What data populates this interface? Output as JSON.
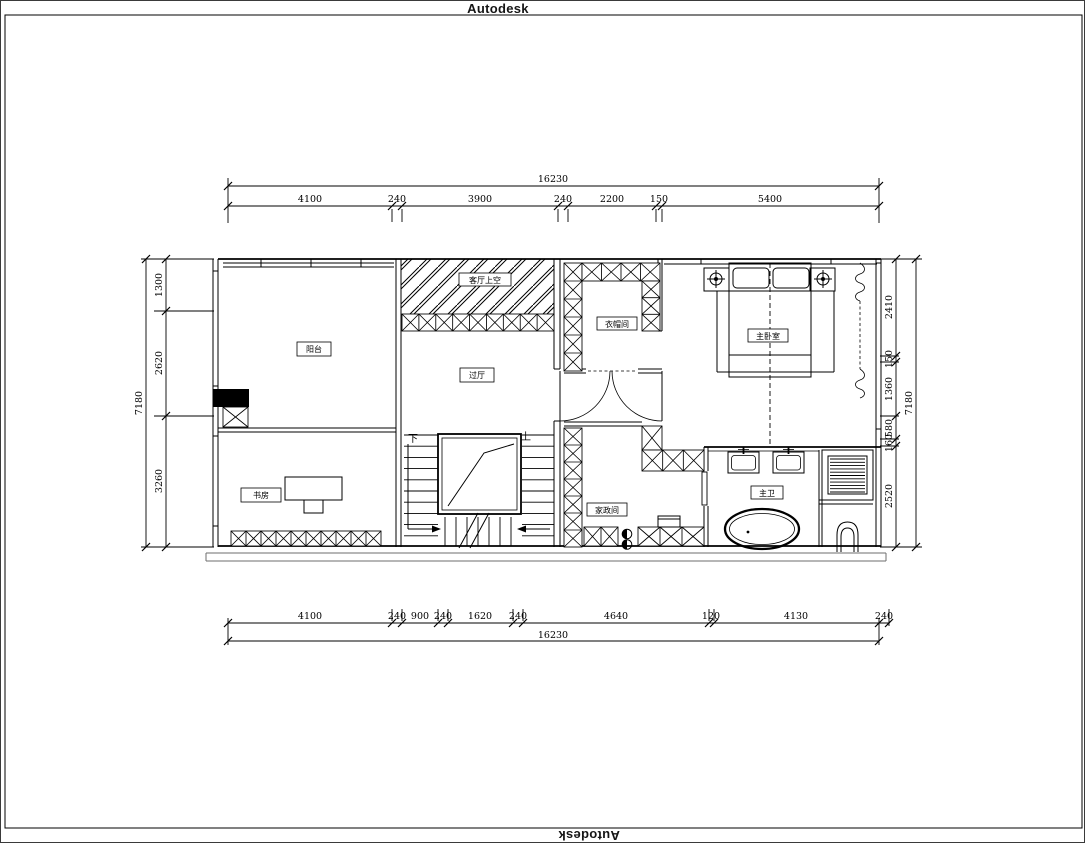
{
  "watermark": {
    "top_label": "Autodesk",
    "bottom_label": "Autodesk"
  },
  "rooms": {
    "balcony": "阳台",
    "study": "书房",
    "void_above_living": "客厅上空",
    "hall": "过厅",
    "cloakroom": "衣帽间",
    "master_bedroom": "主卧室",
    "housekeeping": "家政间",
    "master_bath": "主卫"
  },
  "stairs": {
    "down_label": "下",
    "up_label": "上"
  },
  "dimensions": {
    "top": {
      "overall": "16230",
      "segments": [
        "4100",
        "240",
        "3900",
        "240",
        "2200",
        "150",
        "5400"
      ]
    },
    "bottom": {
      "overall": "16230",
      "segments": [
        "4100",
        "240",
        "900",
        "240",
        "1620",
        "240",
        "4640",
        "120",
        "4130",
        "240"
      ]
    },
    "left": {
      "overall": "7180",
      "segments": [
        "1300",
        "2620",
        "3260"
      ]
    },
    "right": {
      "overall": "7180",
      "segments": [
        "2410",
        "150",
        "1360",
        "580",
        "160",
        "2520"
      ]
    }
  },
  "colors": {
    "line": "#000000",
    "background": "#ffffff"
  }
}
